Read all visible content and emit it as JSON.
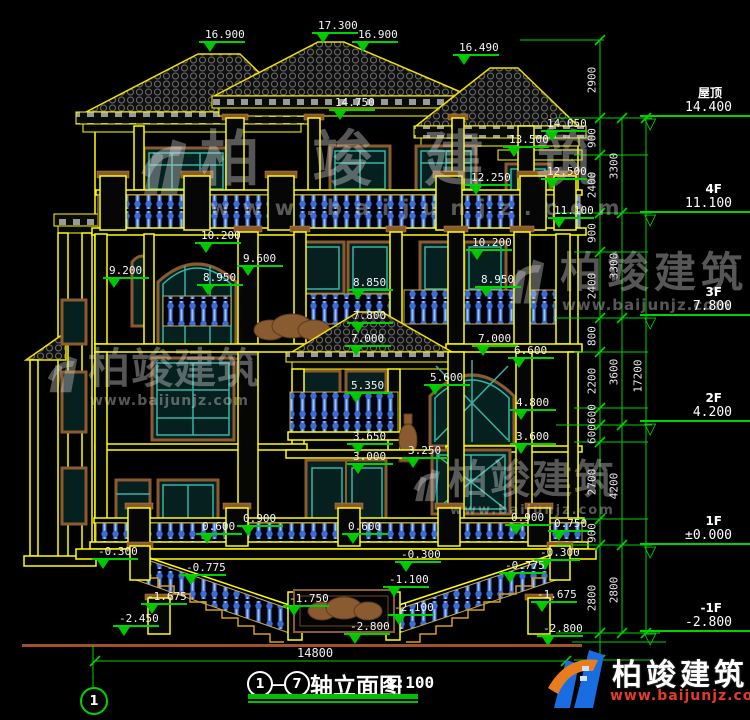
{
  "title_block": {
    "axis_from": "1",
    "dash": "—",
    "axis_to": "7",
    "text": "轴立面图",
    "scale": "1:100"
  },
  "axis_bubble": {
    "label": "1"
  },
  "bottom_dim": {
    "text": "14800"
  },
  "logo": {
    "cn": "柏竣建筑",
    "url": "www.baijunjz.com"
  },
  "colors": {
    "dim_green": "#00d400",
    "line_yellow": "#ffff00",
    "baluster_blue": "#4a7de0",
    "window_teal": "#38b2a2",
    "frame_brown": "#8a5a30",
    "logo_blue": "#1a6de0",
    "logo_red": "#e23b2e",
    "ground_brown": "#a0522d"
  },
  "watermarks": [
    {
      "cn": "柏竣建筑",
      "url": "www.baijunjz.com",
      "x": 200,
      "y": 130,
      "size": 60,
      "ls": 52,
      "url_x": 210,
      "url_y": 198,
      "url_size": 21,
      "url_ls": 13,
      "icon": {
        "x": 138,
        "y": 132,
        "w": 56,
        "h": 66
      }
    },
    {
      "cn": "柏竣建筑",
      "url": "www.baijunjz.com",
      "x": 88,
      "y": 348,
      "size": 42,
      "ls": 1,
      "url_x": 90,
      "url_y": 394,
      "url_size": 14,
      "url_ls": 1,
      "icon": {
        "x": 46,
        "y": 346,
        "w": 36,
        "h": 54
      }
    },
    {
      "cn": "柏竣建筑",
      "url": "www.baijunjz.com",
      "x": 560,
      "y": 252,
      "size": 42,
      "ls": 5,
      "url_x": 562,
      "url_y": 298,
      "url_size": 15,
      "url_ls": 1,
      "icon": {
        "x": 506,
        "y": 252,
        "w": 44,
        "h": 56
      }
    },
    {
      "cn": "柏竣建筑",
      "url": "www.baijunjz.com",
      "x": 448,
      "y": 460,
      "size": 40,
      "ls": 2,
      "url_x": 450,
      "url_y": 504,
      "url_size": 13,
      "url_ls": 2,
      "icon": {
        "x": 412,
        "y": 458,
        "w": 32,
        "h": 52
      }
    }
  ],
  "elevation_markers": [
    {
      "t": "16.900",
      "x": 199,
      "y": 29
    },
    {
      "t": "17.300",
      "x": 312,
      "y": 20
    },
    {
      "t": "16.900",
      "x": 352,
      "y": 29
    },
    {
      "t": "16.490",
      "x": 453,
      "y": 42
    },
    {
      "t": "14.750",
      "x": 329,
      "y": 97
    },
    {
      "t": "14.050",
      "x": 541,
      "y": 118
    },
    {
      "t": "13.500",
      "x": 503,
      "y": 134
    },
    {
      "t": "12.500",
      "x": 541,
      "y": 166
    },
    {
      "t": "12.250",
      "x": 465,
      "y": 172
    },
    {
      "t": "11.100",
      "x": 548,
      "y": 205
    },
    {
      "t": "10.200",
      "x": 195,
      "y": 230
    },
    {
      "t": "10.200",
      "x": 466,
      "y": 237
    },
    {
      "t": "9.600",
      "x": 237,
      "y": 253
    },
    {
      "t": "9.200",
      "x": 103,
      "y": 265
    },
    {
      "t": "8.950",
      "x": 197,
      "y": 272
    },
    {
      "t": "8.850",
      "x": 347,
      "y": 277
    },
    {
      "t": "8.950",
      "x": 475,
      "y": 274
    },
    {
      "t": "7.800",
      "x": 347,
      "y": 310
    },
    {
      "t": "7.000",
      "x": 345,
      "y": 333
    },
    {
      "t": "7.000",
      "x": 472,
      "y": 333
    },
    {
      "t": "6.600",
      "x": 508,
      "y": 345
    },
    {
      "t": "5.350",
      "x": 345,
      "y": 380
    },
    {
      "t": "5.600",
      "x": 424,
      "y": 372
    },
    {
      "t": "4.800",
      "x": 510,
      "y": 397
    },
    {
      "t": "3.650",
      "x": 347,
      "y": 431
    },
    {
      "t": "3.600",
      "x": 510,
      "y": 431
    },
    {
      "t": "3.250",
      "x": 402,
      "y": 445
    },
    {
      "t": "3.000",
      "x": 347,
      "y": 451
    },
    {
      "t": "0.600",
      "x": 196,
      "y": 521
    },
    {
      "t": "0.900",
      "x": 237,
      "y": 513
    },
    {
      "t": "0.600",
      "x": 342,
      "y": 521
    },
    {
      "t": "0.900",
      "x": 505,
      "y": 512
    },
    {
      "t": "0.750",
      "x": 548,
      "y": 518
    },
    {
      "t": "-0.300",
      "x": 92,
      "y": 546
    },
    {
      "t": "-0.300",
      "x": 395,
      "y": 549
    },
    {
      "t": "-0.300",
      "x": 534,
      "y": 547
    },
    {
      "t": "-0.775",
      "x": 180,
      "y": 562
    },
    {
      "t": "-0.775",
      "x": 499,
      "y": 560
    },
    {
      "t": "-1.100",
      "x": 383,
      "y": 574
    },
    {
      "t": "-1.675",
      "x": 141,
      "y": 591
    },
    {
      "t": "-1.675",
      "x": 531,
      "y": 589
    },
    {
      "t": "-1.750",
      "x": 283,
      "y": 593
    },
    {
      "t": "-2.100",
      "x": 388,
      "y": 602
    },
    {
      "t": "-2.450",
      "x": 113,
      "y": 613
    },
    {
      "t": "-2.800",
      "x": 344,
      "y": 621
    },
    {
      "t": "-2.800",
      "x": 537,
      "y": 623
    }
  ],
  "right_panel": {
    "levels": [
      {
        "label": "屋顶",
        "value": "14.400",
        "y": 117
      },
      {
        "label": "4F",
        "value": "11.100",
        "y": 213
      },
      {
        "label": "3F",
        "value": "7.800",
        "y": 316
      },
      {
        "label": "2F",
        "value": "4.200",
        "y": 422
      },
      {
        "label": "1F",
        "value": "±0.000",
        "y": 545
      },
      {
        "label": "-1F",
        "value": "-2.800",
        "y": 632
      }
    ],
    "chains": [
      {
        "x": 600,
        "y1": 40,
        "y2": 660,
        "ticks": [
          40,
          118,
          155,
          213,
          252,
          318,
          352,
          408,
          425,
          442,
          519,
          545,
          633,
          660
        ],
        "labels": [
          {
            "t": "2900",
            "y": 80
          },
          {
            "t": "900",
            "y": 138
          },
          {
            "t": "2400",
            "y": 185
          },
          {
            "t": "900",
            "y": 233
          },
          {
            "t": "2400",
            "y": 286
          },
          {
            "t": "800",
            "y": 336
          },
          {
            "t": "2200",
            "y": 381
          },
          {
            "t": "600",
            "y": 414
          },
          {
            "t": "600",
            "y": 434
          },
          {
            "t": "2700",
            "y": 482
          },
          {
            "t": "900",
            "y": 533
          },
          {
            "t": "2800",
            "y": 598
          }
        ]
      },
      {
        "x": 622,
        "y1": 118,
        "y2": 633,
        "ticks": [
          118,
          213,
          318,
          425,
          545,
          633
        ],
        "labels": [
          {
            "t": "3300",
            "y": 166
          },
          {
            "t": "3300",
            "y": 266
          },
          {
            "t": "3600",
            "y": 372
          },
          {
            "t": "4200",
            "y": 486
          },
          {
            "t": "2800",
            "y": 590
          }
        ]
      },
      {
        "x": 646,
        "y1": 118,
        "y2": 633,
        "ticks": [
          118,
          633
        ],
        "labels": [
          {
            "t": "17200",
            "y": 376
          }
        ]
      }
    ]
  },
  "scaffold": {
    "hlines": [
      [
        520,
        40,
        604
      ],
      [
        556,
        118,
        652
      ],
      [
        574,
        155,
        648
      ],
      [
        556,
        213,
        652
      ],
      [
        574,
        252,
        648
      ],
      [
        556,
        318,
        652
      ],
      [
        574,
        352,
        648
      ],
      [
        574,
        408,
        648
      ],
      [
        556,
        425,
        652
      ],
      [
        574,
        442,
        648
      ],
      [
        574,
        519,
        648
      ],
      [
        556,
        545,
        652
      ],
      [
        556,
        633,
        660
      ],
      [
        574,
        660,
        650
      ],
      [
        95,
        661,
        566
      ],
      [
        572,
        642,
        666
      ]
    ],
    "vlines": [
      [
        93,
        645,
        687
      ]
    ],
    "free_ticks": [
      [
        95,
        661
      ],
      [
        566,
        661
      ]
    ]
  }
}
